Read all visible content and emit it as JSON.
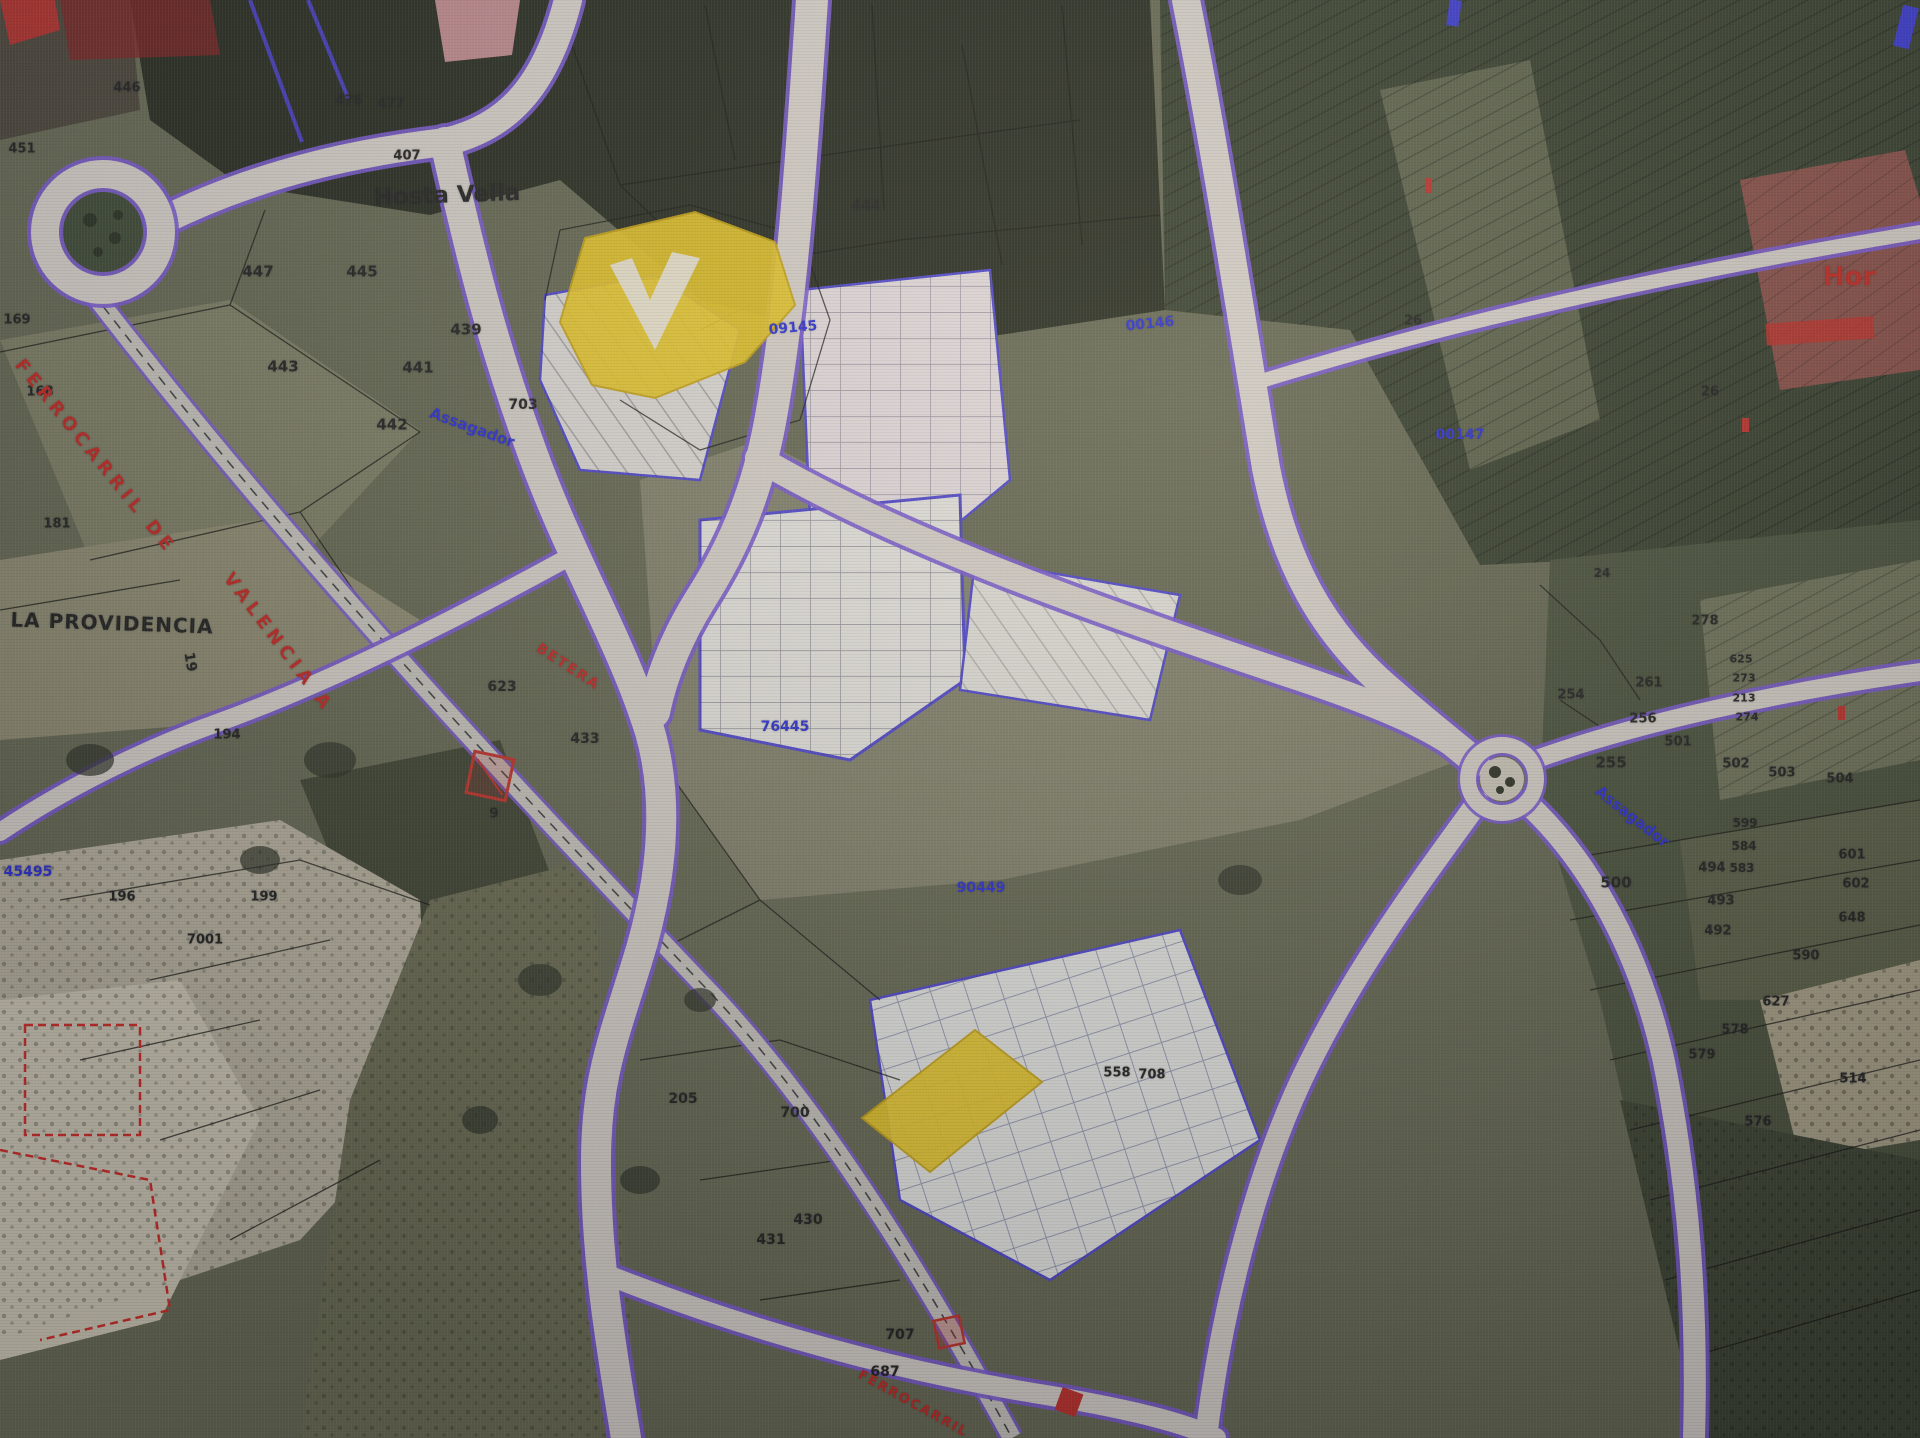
{
  "colors": {
    "ink": "#20211e",
    "blue": "#2b2fd4",
    "red": "#c32820",
    "yellow": "#e9c824",
    "purple": "#7a5ad2",
    "road": "#d8d2c9",
    "forest": "#272b1d",
    "field": "#666951"
  },
  "map": {
    "labels": [
      {
        "text": "Hosta Vella",
        "x": 447,
        "y": 196,
        "size": 23,
        "color": "ink",
        "rot": -2,
        "weight": 700,
        "name": "toponym-hosta-vella"
      },
      {
        "text": "LA PROVIDENCIA",
        "x": 112,
        "y": 623,
        "size": 20,
        "color": "ink",
        "rot": 2,
        "weight": 700,
        "ls": 1,
        "name": "toponym-la-providencia"
      },
      {
        "text": "Hor",
        "x": 1849,
        "y": 277,
        "size": 26,
        "color": "red",
        "weight": 700,
        "name": "toponym-hor"
      },
      {
        "text": "451",
        "x": 22,
        "y": 149,
        "size": 13,
        "name": "parcel-number"
      },
      {
        "text": "446",
        "x": 127,
        "y": 88,
        "size": 13,
        "name": "parcel-number"
      },
      {
        "text": "476",
        "x": 349,
        "y": 101,
        "size": 13,
        "name": "parcel-number"
      },
      {
        "text": "477",
        "x": 391,
        "y": 104,
        "size": 13,
        "name": "parcel-number"
      },
      {
        "text": "407",
        "x": 407,
        "y": 156,
        "size": 13,
        "name": "parcel-number"
      },
      {
        "text": "444",
        "x": 866,
        "y": 206,
        "size": 14,
        "name": "parcel-number"
      },
      {
        "text": "447",
        "x": 258,
        "y": 272,
        "size": 15,
        "name": "parcel-number"
      },
      {
        "text": "445",
        "x": 362,
        "y": 272,
        "size": 15,
        "name": "parcel-number"
      },
      {
        "text": "439",
        "x": 466,
        "y": 330,
        "size": 15,
        "name": "parcel-number"
      },
      {
        "text": "443",
        "x": 283,
        "y": 367,
        "size": 15,
        "name": "parcel-number"
      },
      {
        "text": "441",
        "x": 418,
        "y": 368,
        "size": 15,
        "name": "parcel-number"
      },
      {
        "text": "442",
        "x": 392,
        "y": 425,
        "size": 15,
        "name": "parcel-number"
      },
      {
        "text": "703",
        "x": 523,
        "y": 405,
        "size": 14,
        "name": "parcel-number"
      },
      {
        "text": "169",
        "x": 17,
        "y": 320,
        "size": 13,
        "name": "parcel-number"
      },
      {
        "text": "168",
        "x": 40,
        "y": 392,
        "size": 13,
        "name": "parcel-number"
      },
      {
        "text": "181",
        "x": 57,
        "y": 524,
        "size": 13,
        "name": "parcel-number"
      },
      {
        "text": "19",
        "x": 190,
        "y": 662,
        "size": 14,
        "rot": 80,
        "name": "parcel-number"
      },
      {
        "text": "623",
        "x": 502,
        "y": 687,
        "size": 14,
        "name": "parcel-number"
      },
      {
        "text": "433",
        "x": 585,
        "y": 739,
        "size": 14,
        "name": "parcel-number"
      },
      {
        "text": "194",
        "x": 227,
        "y": 735,
        "size": 13,
        "name": "parcel-number"
      },
      {
        "text": "196",
        "x": 122,
        "y": 897,
        "size": 13,
        "name": "parcel-number"
      },
      {
        "text": "199",
        "x": 264,
        "y": 897,
        "size": 13,
        "name": "parcel-number"
      },
      {
        "text": "7001",
        "x": 205,
        "y": 940,
        "size": 13,
        "name": "parcel-number"
      },
      {
        "text": "9",
        "x": 494,
        "y": 814,
        "size": 13,
        "name": "parcel-number"
      },
      {
        "text": "205",
        "x": 683,
        "y": 1099,
        "size": 14,
        "name": "parcel-number"
      },
      {
        "text": "700",
        "x": 795,
        "y": 1113,
        "size": 14,
        "name": "parcel-number"
      },
      {
        "text": "430",
        "x": 808,
        "y": 1220,
        "size": 14,
        "name": "parcel-number"
      },
      {
        "text": "431",
        "x": 771,
        "y": 1240,
        "size": 14,
        "name": "parcel-number"
      },
      {
        "text": "707",
        "x": 900,
        "y": 1335,
        "size": 14,
        "name": "parcel-number"
      },
      {
        "text": "687",
        "x": 885,
        "y": 1372,
        "size": 14,
        "name": "parcel-number"
      },
      {
        "text": "558",
        "x": 1117,
        "y": 1073,
        "size": 13,
        "name": "parcel-number"
      },
      {
        "text": "708",
        "x": 1152,
        "y": 1075,
        "size": 13,
        "name": "parcel-number"
      },
      {
        "text": "24",
        "x": 1602,
        "y": 573,
        "size": 12,
        "name": "parcel-number"
      },
      {
        "text": "26",
        "x": 1710,
        "y": 392,
        "size": 13,
        "name": "parcel-number"
      },
      {
        "text": "26",
        "x": 1413,
        "y": 321,
        "size": 13,
        "name": "parcel-number"
      },
      {
        "text": "261",
        "x": 1649,
        "y": 683,
        "size": 13,
        "name": "parcel-number"
      },
      {
        "text": "256",
        "x": 1643,
        "y": 719,
        "size": 13,
        "name": "parcel-number"
      },
      {
        "text": "254",
        "x": 1571,
        "y": 695,
        "size": 13,
        "name": "parcel-number"
      },
      {
        "text": "255",
        "x": 1611,
        "y": 763,
        "size": 15,
        "name": "parcel-number"
      },
      {
        "text": "278",
        "x": 1705,
        "y": 621,
        "size": 13,
        "name": "parcel-number"
      },
      {
        "text": "625",
        "x": 1741,
        "y": 659,
        "size": 11,
        "name": "parcel-number"
      },
      {
        "text": "273",
        "x": 1744,
        "y": 678,
        "size": 11,
        "name": "parcel-number"
      },
      {
        "text": "213",
        "x": 1744,
        "y": 698,
        "size": 11,
        "name": "parcel-number"
      },
      {
        "text": "274",
        "x": 1747,
        "y": 717,
        "size": 11,
        "name": "parcel-number"
      },
      {
        "text": "500",
        "x": 1616,
        "y": 883,
        "size": 15,
        "name": "parcel-number"
      },
      {
        "text": "501",
        "x": 1678,
        "y": 742,
        "size": 13,
        "name": "parcel-number"
      },
      {
        "text": "502",
        "x": 1736,
        "y": 764,
        "size": 13,
        "name": "parcel-number"
      },
      {
        "text": "503",
        "x": 1782,
        "y": 773,
        "size": 13,
        "name": "parcel-number"
      },
      {
        "text": "504",
        "x": 1840,
        "y": 779,
        "size": 13,
        "name": "parcel-number"
      },
      {
        "text": "599",
        "x": 1745,
        "y": 823,
        "size": 12,
        "name": "parcel-number"
      },
      {
        "text": "584",
        "x": 1744,
        "y": 846,
        "size": 12,
        "name": "parcel-number"
      },
      {
        "text": "583",
        "x": 1742,
        "y": 868,
        "size": 12,
        "name": "parcel-number"
      },
      {
        "text": "494",
        "x": 1712,
        "y": 868,
        "size": 13,
        "name": "parcel-number"
      },
      {
        "text": "493",
        "x": 1721,
        "y": 901,
        "size": 13,
        "name": "parcel-number"
      },
      {
        "text": "492",
        "x": 1718,
        "y": 931,
        "size": 13,
        "name": "parcel-number"
      },
      {
        "text": "601",
        "x": 1852,
        "y": 855,
        "size": 13,
        "name": "parcel-number"
      },
      {
        "text": "602",
        "x": 1856,
        "y": 884,
        "size": 13,
        "name": "parcel-number"
      },
      {
        "text": "648",
        "x": 1852,
        "y": 918,
        "size": 13,
        "name": "parcel-number"
      },
      {
        "text": "590",
        "x": 1806,
        "y": 956,
        "size": 13,
        "name": "parcel-number"
      },
      {
        "text": "627",
        "x": 1776,
        "y": 1002,
        "size": 13,
        "name": "parcel-number"
      },
      {
        "text": "578",
        "x": 1735,
        "y": 1030,
        "size": 13,
        "name": "parcel-number"
      },
      {
        "text": "579",
        "x": 1702,
        "y": 1055,
        "size": 13,
        "name": "parcel-number"
      },
      {
        "text": "576",
        "x": 1758,
        "y": 1122,
        "size": 13,
        "name": "parcel-number"
      },
      {
        "text": "514",
        "x": 1853,
        "y": 1079,
        "size": 13,
        "name": "parcel-number"
      },
      {
        "text": "09145",
        "x": 793,
        "y": 328,
        "size": 14,
        "color": "blue",
        "rot": -5,
        "weight": 700,
        "name": "masa-number"
      },
      {
        "text": "00146",
        "x": 1150,
        "y": 324,
        "size": 14,
        "color": "blue",
        "rot": -6,
        "weight": 700,
        "name": "masa-number"
      },
      {
        "text": "00147",
        "x": 1460,
        "y": 435,
        "size": 14,
        "color": "blue",
        "weight": 700,
        "name": "masa-number"
      },
      {
        "text": "76445",
        "x": 785,
        "y": 727,
        "size": 14,
        "color": "blue",
        "weight": 700,
        "name": "masa-number"
      },
      {
        "text": "90449",
        "x": 981,
        "y": 888,
        "size": 14,
        "color": "blue",
        "weight": 700,
        "name": "masa-number"
      },
      {
        "text": "45495",
        "x": 28,
        "y": 872,
        "size": 14,
        "color": "blue",
        "weight": 700,
        "name": "masa-number"
      },
      {
        "text": "Assagador",
        "x": 472,
        "y": 428,
        "size": 15,
        "color": "blue",
        "rot": 20,
        "weight": 700,
        "name": "path-label-assagador-west"
      },
      {
        "text": "Assagador",
        "x": 1632,
        "y": 817,
        "size": 15,
        "color": "blue",
        "rot": 38,
        "weight": 700,
        "name": "path-label-assagador-east"
      },
      {
        "text": "FERROCARRIL DE",
        "x": 95,
        "y": 457,
        "size": 18,
        "color": "red",
        "rot": 51,
        "weight": 700,
        "ls": 5,
        "name": "railway-label"
      },
      {
        "text": "VALENCIA A",
        "x": 278,
        "y": 643,
        "size": 18,
        "color": "red",
        "rot": 53,
        "weight": 700,
        "ls": 5,
        "name": "railway-label"
      },
      {
        "text": "BETERA",
        "x": 568,
        "y": 667,
        "size": 14,
        "color": "red",
        "rot": 33,
        "weight": 700,
        "ls": 2,
        "name": "railway-label"
      },
      {
        "text": "FERROCARRIL",
        "x": 913,
        "y": 1404,
        "size": 13,
        "color": "red",
        "rot": 29,
        "weight": 700,
        "ls": 2,
        "name": "railway-label"
      }
    ],
    "highlighted_parcels": [
      {
        "id": "north",
        "label": "selected parcel (north)"
      },
      {
        "id": "south",
        "label": "selected parcel (south)"
      }
    ]
  }
}
